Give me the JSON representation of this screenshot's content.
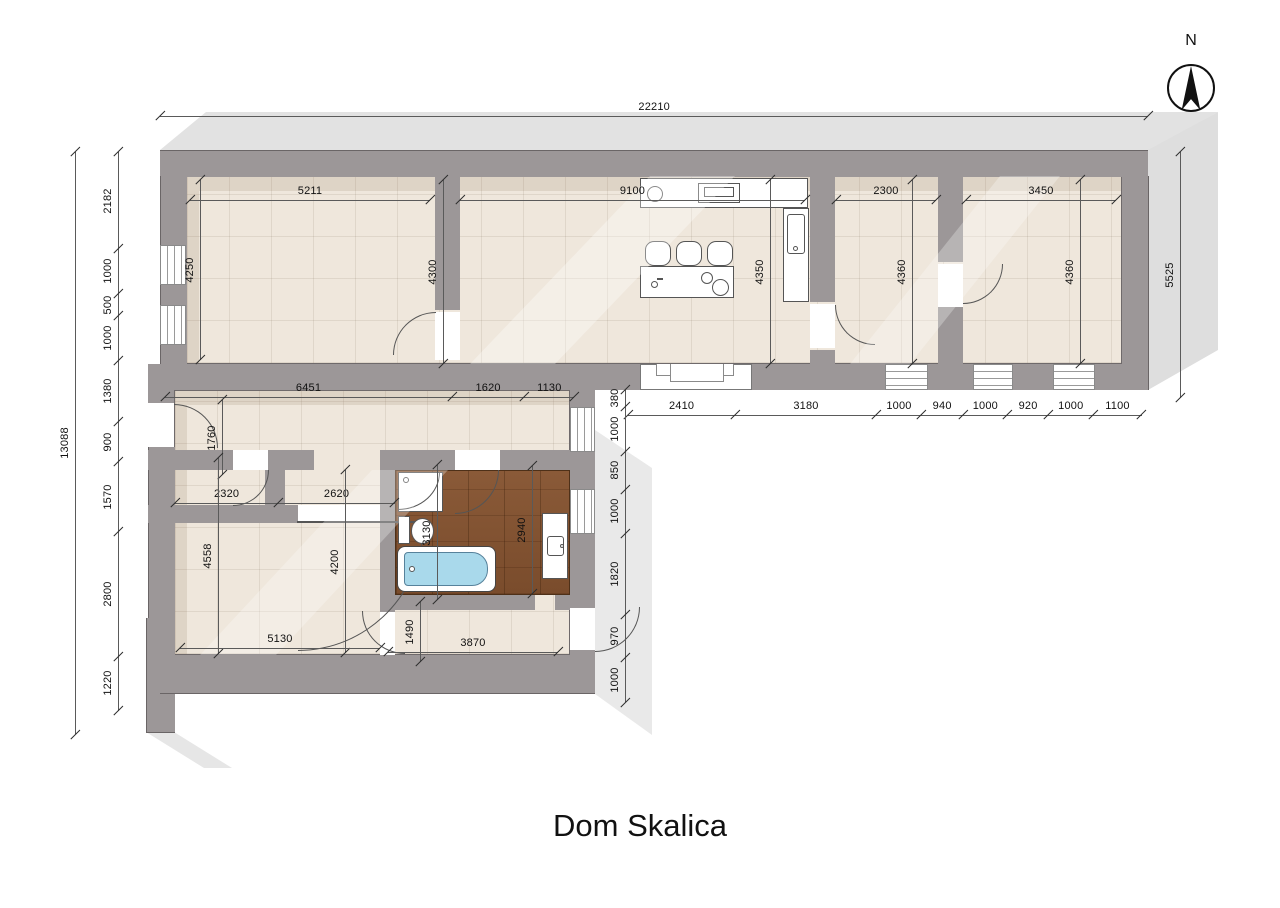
{
  "title": "Dom Skalica",
  "compass_label": "N",
  "scale_px_per_mm": 0.0445,
  "colors": {
    "wall": "#9c9798",
    "floor": "#efe7dc",
    "wood_floor": "#855536",
    "extrusion_shadow": "#e2e2e2",
    "bath_water": "#a9d9eb",
    "dimension_line": "#5a5a5a",
    "text": "#111111"
  },
  "overall_dimensions": {
    "top": "22210",
    "left": "13088",
    "right": "5525"
  },
  "dim_chains": [
    {
      "id": "top-overall",
      "dir": "h",
      "x": 160,
      "y": 116,
      "segments": [
        {
          "label": "22210",
          "mm": 22210
        }
      ]
    },
    {
      "id": "left-overall",
      "dir": "v",
      "x": 75,
      "y": 152,
      "segments": [
        {
          "label": "13088",
          "mm": 13088
        }
      ]
    },
    {
      "id": "left-wall",
      "dir": "v",
      "x": 118,
      "y": 152,
      "segments": [
        {
          "label": "2182",
          "mm": 2182
        },
        {
          "label": "1000",
          "mm": 1000
        },
        {
          "label": "500",
          "mm": 500
        },
        {
          "label": "1000",
          "mm": 1000
        },
        {
          "label": "1380",
          "mm": 1380
        },
        {
          "label": "900",
          "mm": 900
        },
        {
          "label": "1570",
          "mm": 1570
        },
        {
          "label": "2800",
          "mm": 2800
        },
        {
          "label": "1220",
          "mm": 1220
        }
      ]
    },
    {
      "id": "right-overall",
      "dir": "v",
      "x": 1180,
      "y": 152,
      "segments": [
        {
          "label": "5525",
          "mm": 5525
        }
      ]
    },
    {
      "id": "room1-width",
      "dir": "h",
      "x": 190,
      "y": 200,
      "segments": [
        {
          "label": "5211",
          "mm": 5211,
          "len": 240
        }
      ]
    },
    {
      "id": "living-width",
      "dir": "h",
      "x": 460,
      "y": 200,
      "segments": [
        {
          "label": "9100",
          "mm": 9100,
          "len": 345
        }
      ]
    },
    {
      "id": "room3-width",
      "dir": "h",
      "x": 836,
      "y": 200,
      "segments": [
        {
          "label": "2300",
          "mm": 2300,
          "len": 100
        }
      ]
    },
    {
      "id": "room4-width",
      "dir": "h",
      "x": 966,
      "y": 200,
      "segments": [
        {
          "label": "3450",
          "mm": 3450,
          "len": 150
        }
      ]
    },
    {
      "id": "room1-height",
      "dir": "v",
      "x": 200,
      "y": 180,
      "segments": [
        {
          "label": "4250",
          "mm": 4250,
          "len": 180
        }
      ]
    },
    {
      "id": "living-left-height",
      "dir": "v",
      "x": 443,
      "y": 180,
      "segments": [
        {
          "label": "4300",
          "mm": 4300,
          "len": 184
        }
      ]
    },
    {
      "id": "living-right-height",
      "dir": "v",
      "x": 770,
      "y": 180,
      "segments": [
        {
          "label": "4350",
          "mm": 4350,
          "len": 184
        }
      ]
    },
    {
      "id": "room3-height",
      "dir": "v",
      "x": 912,
      "y": 180,
      "segments": [
        {
          "label": "4360",
          "mm": 4360,
          "len": 184
        }
      ]
    },
    {
      "id": "room4-height",
      "dir": "v",
      "x": 1080,
      "y": 180,
      "segments": [
        {
          "label": "4360",
          "mm": 4360,
          "len": 184
        }
      ]
    },
    {
      "id": "south-wall",
      "dir": "h",
      "x": 628,
      "y": 415,
      "segments": [
        {
          "label": "2410",
          "mm": 2410
        },
        {
          "label": "3180",
          "mm": 3180
        },
        {
          "label": "1000",
          "mm": 1000
        },
        {
          "label": "940",
          "mm": 940
        },
        {
          "label": "1000",
          "mm": 1000
        },
        {
          "label": "920",
          "mm": 920
        },
        {
          "label": "1000",
          "mm": 1000
        },
        {
          "label": "1100",
          "mm": 1100
        }
      ]
    },
    {
      "id": "corridor",
      "dir": "h",
      "x": 165,
      "y": 397,
      "segments": [
        {
          "label": "6451",
          "mm": 6451
        },
        {
          "label": "1620",
          "mm": 1620
        },
        {
          "label": "1130",
          "mm": 1130
        }
      ]
    },
    {
      "id": "corridor-height",
      "dir": "v",
      "x": 222,
      "y": 400,
      "segments": [
        {
          "label": "1760",
          "mm": 1760,
          "len": 75
        }
      ]
    },
    {
      "id": "hall",
      "dir": "h",
      "x": 175,
      "y": 503,
      "segments": [
        {
          "label": "2320",
          "mm": 2320
        },
        {
          "label": "2620",
          "mm": 2620
        }
      ]
    },
    {
      "id": "east-wing",
      "dir": "v",
      "x": 625,
      "y": 390,
      "segments": [
        {
          "label": "380",
          "mm": 380
        },
        {
          "label": "1000",
          "mm": 1000
        },
        {
          "label": "850",
          "mm": 850
        },
        {
          "label": "1000",
          "mm": 1000
        },
        {
          "label": "1820",
          "mm": 1820
        },
        {
          "label": "970",
          "mm": 970
        },
        {
          "label": "1000",
          "mm": 1000
        }
      ]
    },
    {
      "id": "bath-left-height",
      "dir": "v",
      "x": 437,
      "y": 465,
      "segments": [
        {
          "label": "3130",
          "mm": 3130,
          "len": 135
        }
      ]
    },
    {
      "id": "bath-right-height",
      "dir": "v",
      "x": 532,
      "y": 466,
      "segments": [
        {
          "label": "2940",
          "mm": 2940,
          "len": 128
        }
      ]
    },
    {
      "id": "lower-room-left",
      "dir": "v",
      "x": 218,
      "y": 458,
      "segments": [
        {
          "label": "4558",
          "mm": 4558,
          "len": 196
        }
      ]
    },
    {
      "id": "lower-room-right",
      "dir": "v",
      "x": 345,
      "y": 470,
      "segments": [
        {
          "label": "4200",
          "mm": 4200,
          "len": 183
        }
      ]
    },
    {
      "id": "lower-room-width",
      "dir": "h",
      "x": 180,
      "y": 648,
      "segments": [
        {
          "label": "5130",
          "mm": 5130,
          "len": 200
        }
      ]
    },
    {
      "id": "vestibule-height",
      "dir": "v",
      "x": 420,
      "y": 602,
      "segments": [
        {
          "label": "1490",
          "mm": 1490,
          "len": 60
        }
      ]
    },
    {
      "id": "vestibule-width",
      "dir": "h",
      "x": 388,
      "y": 652,
      "segments": [
        {
          "label": "3870",
          "mm": 3870,
          "len": 170
        }
      ]
    }
  ]
}
